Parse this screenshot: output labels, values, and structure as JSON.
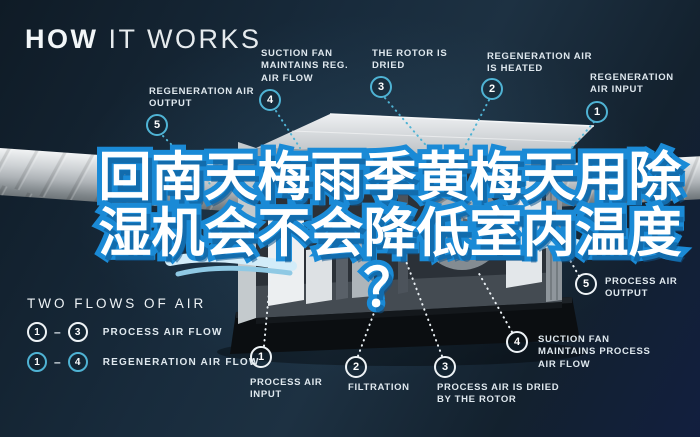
{
  "colors": {
    "background": "#16293a",
    "accent_teal": "#4fb3d4",
    "label_text": "#dfe8ee",
    "headline_fill": "#ffffff",
    "headline_stroke": "#1a8ad6",
    "duct_metal": "#c9cdd0"
  },
  "title": {
    "bold": "HOW",
    "light": "IT WORKS"
  },
  "headline": {
    "line1": "回南天梅雨季黄梅天用除",
    "line2": "湿机会不会降低室内温度",
    "line3": "？"
  },
  "regeneration_labels": [
    {
      "num": "5",
      "label": "REGENERATION AIR OUTPUT"
    },
    {
      "num": "4",
      "label": "SUCTION FAN MAINTAINS REG. AIR FLOW"
    },
    {
      "num": "3",
      "label": "THE ROTOR IS DRIED"
    },
    {
      "num": "2",
      "label": "REGENERATION AIR IS HEATED"
    },
    {
      "num": "1",
      "label": "REGENERATION AIR INPUT"
    }
  ],
  "process_labels": [
    {
      "num": "1",
      "label": "PROCESS AIR INPUT"
    },
    {
      "num": "2",
      "label": "FILTRATION"
    },
    {
      "num": "3",
      "label": "PROCESS AIR IS DRIED BY THE ROTOR"
    },
    {
      "num": "4",
      "label": "SUCTION FAN MAINTAINS PROCESS AIR FLOW"
    },
    {
      "num": "5",
      "label": "PROCESS AIR OUTPUT"
    }
  ],
  "legend": {
    "title": "TWO FLOWS OF AIR",
    "separator": "–",
    "rows": [
      {
        "from": "1",
        "to": "3",
        "label": "PROCESS AIR FLOW"
      },
      {
        "from": "1",
        "to": "4",
        "label": "REGENERATION AIR FLOW"
      }
    ]
  }
}
